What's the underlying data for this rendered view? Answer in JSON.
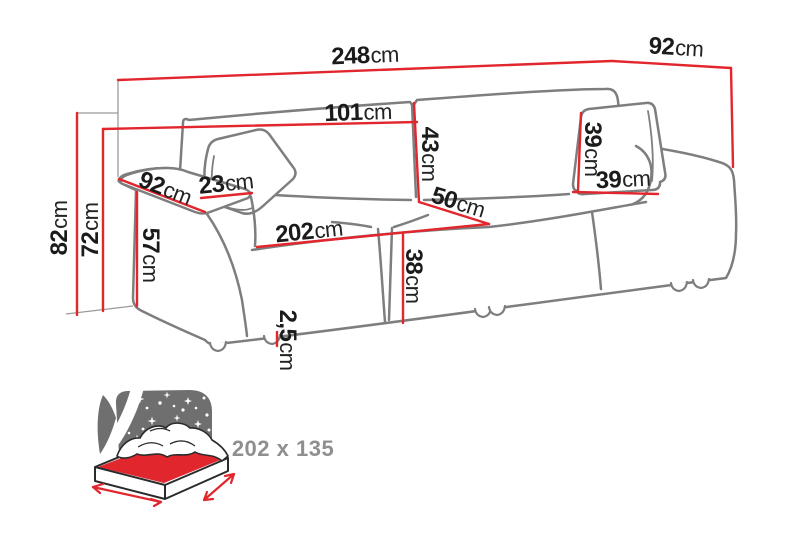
{
  "diagram": {
    "title_hint": "sofa-bed dimension drawing",
    "unit": "cm",
    "dims": {
      "total_width": {
        "v": "248",
        "u": "cm"
      },
      "total_depth": {
        "v": "92",
        "u": "cm"
      },
      "back_width": {
        "v": "101",
        "u": "cm"
      },
      "back_cushion_height": {
        "v": "43",
        "u": "cm"
      },
      "pillow_height": {
        "v": "39",
        "u": "cm"
      },
      "pillow_width": {
        "v": "39",
        "u": "cm"
      },
      "armrest_depth": {
        "v": "92",
        "u": "cm"
      },
      "armrest_width": {
        "v": "23",
        "u": "cm"
      },
      "total_height": {
        "v": "82",
        "u": "cm"
      },
      "backrest_height": {
        "v": "72",
        "u": "cm"
      },
      "armrest_height": {
        "v": "57",
        "u": "cm"
      },
      "seat_depth": {
        "v": "50",
        "u": "cm"
      },
      "seat_width": {
        "v": "202",
        "u": "cm"
      },
      "seat_height": {
        "v": "38",
        "u": "cm"
      },
      "leg_height": {
        "v": "2,5",
        "u": "cm"
      }
    },
    "sleeping_area": {
      "label": "202 x 135"
    },
    "colors": {
      "dimension_red": "#e2262d",
      "outline_gray": "#7e7e7e",
      "construction_gray": "#9a9a9a",
      "label_black": "#1b1b1b",
      "night_gray": "#6f6f6f",
      "sleeping_label_gray": "#8f8f8f",
      "bed_outline": "#2b2b2b"
    }
  }
}
